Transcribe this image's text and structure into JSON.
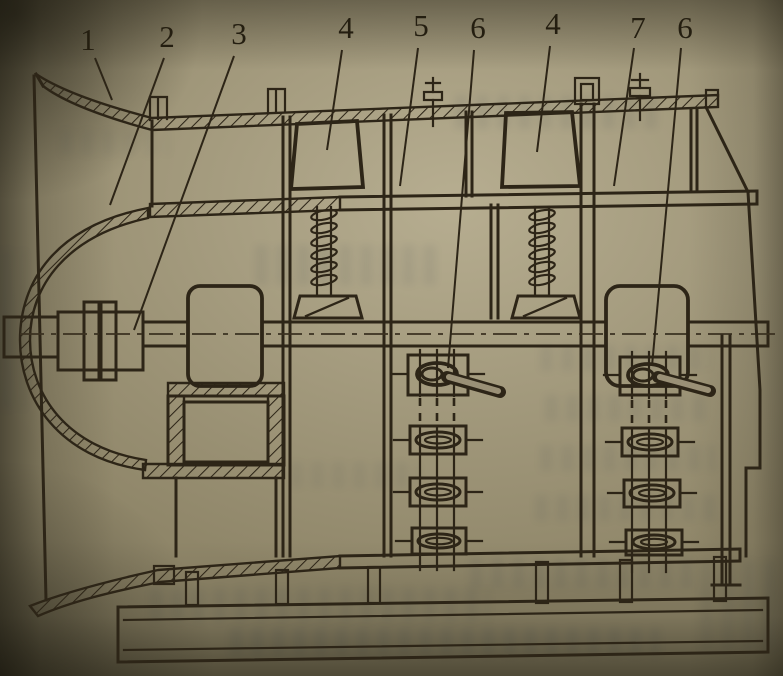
{
  "page": {
    "labels": [
      {
        "text": "1"
      },
      {
        "text": "2"
      },
      {
        "text": "3"
      },
      {
        "text": "4"
      },
      {
        "text": "5"
      },
      {
        "text": "6"
      },
      {
        "text": "4"
      },
      {
        "text": "7"
      },
      {
        "text": "6"
      }
    ],
    "ink_color": "#2d2517",
    "paper_color": "#8f8669"
  }
}
